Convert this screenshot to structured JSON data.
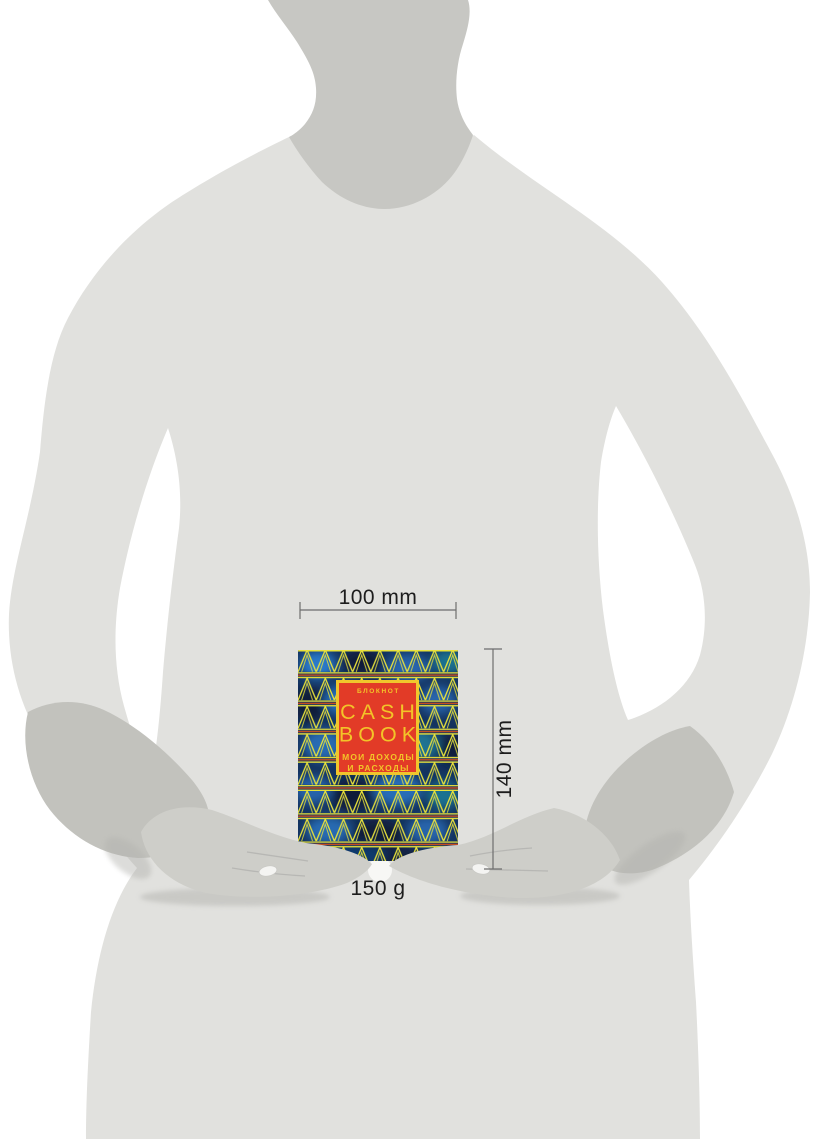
{
  "dimensions": {
    "width_label": "100 mm",
    "height_label": "140 mm",
    "weight_label": "150 g"
  },
  "book_cover": {
    "top_label": "БЛОКНОТ",
    "title_line1": "CASH",
    "title_line2": "BOOK",
    "subtitle_line1": "МОИ ДОХОДЫ",
    "subtitle_line2": "И РАСХОДЫ"
  },
  "colors": {
    "label_red": "#e23b27",
    "label_border_yellow": "#f0c62c",
    "title_yellow": "#f3c428",
    "zigzag_yellow": "#e9e23b",
    "cover_navy": "#14335f",
    "separator_red": "#cf4e1e",
    "body_gray": "#e1e1de",
    "neck_gray": "#c7c7c3",
    "forearm_gray": "#c2c2bd",
    "hand_gray": "#cecec9",
    "shadow_gray": "#b2b2ae",
    "dimension_line": "#6e6e6e",
    "dimension_text": "#1d1d1d"
  }
}
